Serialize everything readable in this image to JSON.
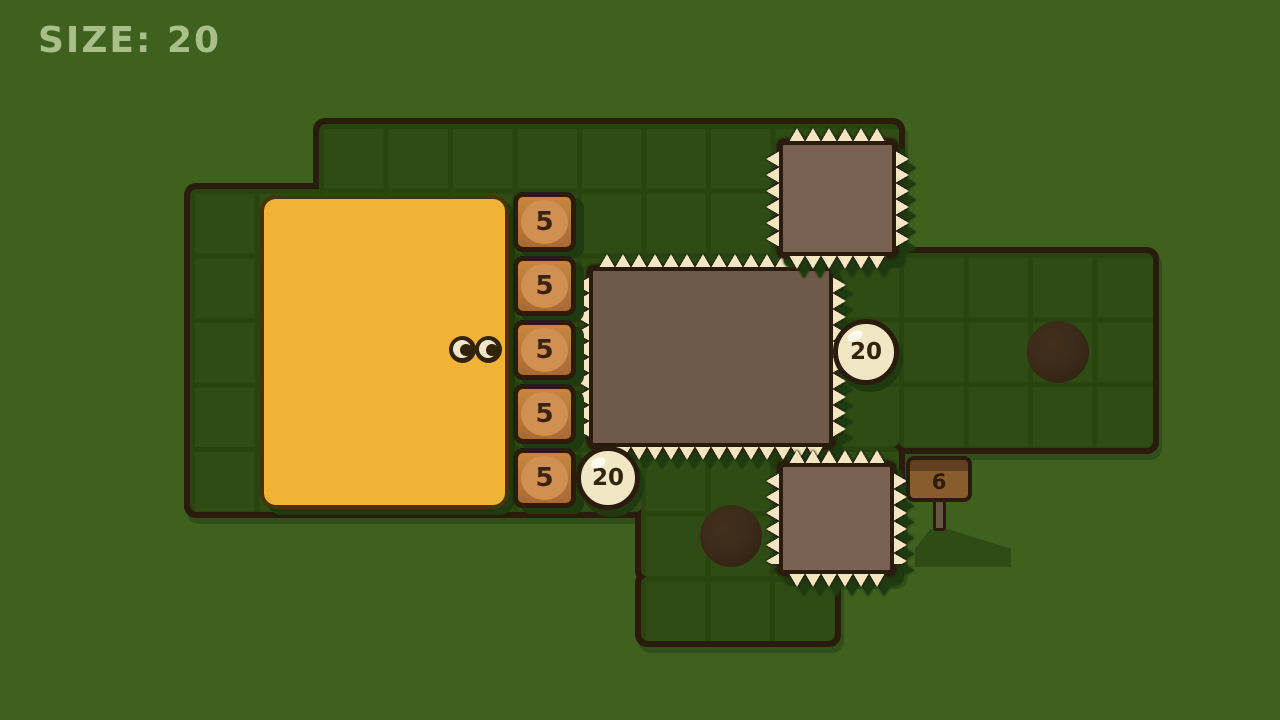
{
  "hud": {
    "size_label": "SIZE: 20"
  },
  "level": {
    "crates": {
      "values": [
        "5",
        "5",
        "5",
        "5",
        "5"
      ]
    },
    "tokens": {
      "mid_right": "20",
      "bottom_left": "20"
    },
    "sign": {
      "value": "6"
    },
    "spiky_boxes": {
      "count": 3
    },
    "holes": {
      "count": 2
    }
  },
  "palette": {
    "background": "#3e611f",
    "board": "#2e4c14",
    "grid_line": "#29440f",
    "outline": "#2a1c0d",
    "shadow_green": "#1e3a0e",
    "title_green": "#a8bf8a",
    "blob_yellow": "#f0b336",
    "crate_circle": "#cf9051",
    "spike_cream": "#f3e6c0",
    "box_brown": "#6f5949",
    "box_brown_light": "#7a6252",
    "token_cream": "#f2e7c4",
    "sign_brown": "#885c2c",
    "sign_band": "#604020",
    "post_brown": "#66553f",
    "sign_shadow_green": "#2f4c16",
    "eye_dark": "#33230d",
    "eye_cream": "#f2e6c8"
  }
}
